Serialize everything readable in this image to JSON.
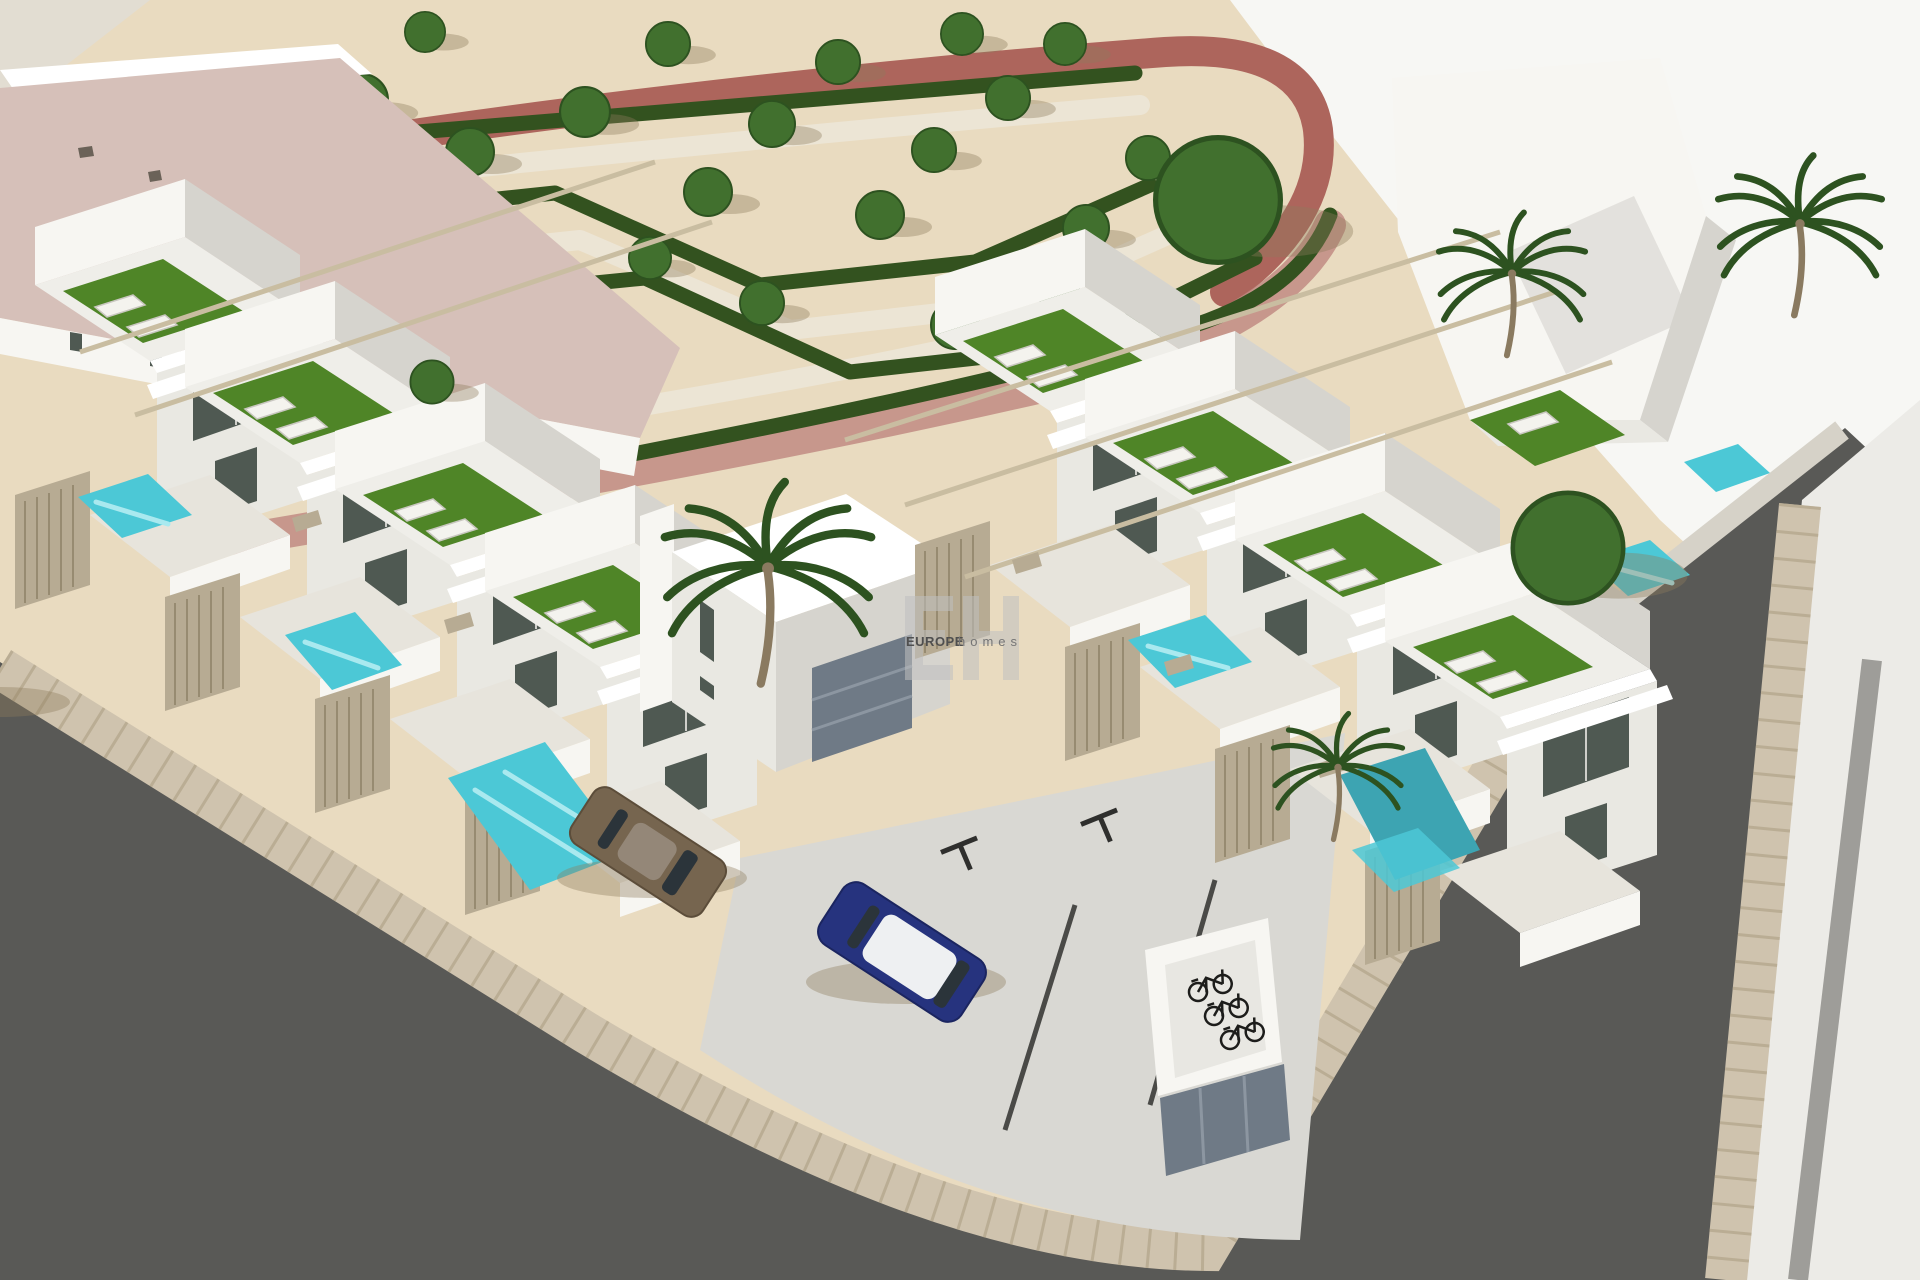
{
  "image": {
    "kind": "3d-architectural-render",
    "view": "aerial-corner-view"
  },
  "watermark": {
    "monogram": "EH",
    "brand": "EUROPE",
    "brand_suffix": "homes"
  },
  "palette": {
    "sand": "#e9dbc0",
    "bright": "#f7f7f4",
    "wedge": "#e2ddd2",
    "parkPath": "#ece5d5",
    "hedge": "#33521f",
    "tree": "#41702e",
    "treeDark": "#2d5220",
    "trunk": "#8a7a60",
    "shadow": "#8d7c5d",
    "redPath": "#ad655c",
    "redPathLight": "#c18b82",
    "pinkRoof": "#d6c0b9",
    "speck": "#6b6258",
    "wallLit": "#f7f6f2",
    "wallMid": "#e9e8e2",
    "wallShade": "#d6d4ce",
    "terrace": "#efeee9",
    "parapet": "#ffffff",
    "glass": "#4f5952",
    "mull": "#cfcfca",
    "turf": "#4f8527",
    "patio": "#e7e4dc",
    "lounger": "#f4f3ee",
    "loungerEdge": "#c9c7c0",
    "fence": "#b7ab93",
    "fenceLine": "#978b71",
    "pool": "#4cc8d6",
    "poolDeep": "#3da4b2",
    "poolLight": "#a9e9ef",
    "pergola": "#c9bda1",
    "road": "#595956",
    "curb": "#cfc3ae",
    "curbJoint": "#b3a58b",
    "lightBand": "#d6d2c8",
    "sidewalk": "#ecebe7",
    "stripe": "#9e9d99",
    "apron": "#d9d8d3",
    "joint": "#4a4a47",
    "markDark": "#2f2f2d",
    "carBronze": "#76654f",
    "carBronzeEdge": "#5c4d3a",
    "carBlue": "#26337e",
    "carBlueEdge": "#1b2560",
    "carGlass": "#2b343a",
    "carRoof": "#eef0f2",
    "bike": "#1d1d1b",
    "shelterFloor": "#e8e7e2",
    "panel": "#6f7a86",
    "panelLine": "#8c96a1",
    "wmGray": "#c0c0c0",
    "wmText": "#4f4f4f",
    "wmText2": "#757575"
  },
  "scene": {
    "labels": [
      "landscaped park with hedge parterre and trees",
      "red walkway around park",
      "pink-roof clubhouse building",
      "left row of white townhouses with rooftop terraces",
      "right row of white townhouses with rooftop terraces",
      "corner tower house",
      "turquoise plunge pools",
      "palm trees",
      "asphalt streets with paver curbs",
      "parking apron with bays",
      "bronze car",
      "blue car with white roof",
      "bicycle shelter with bikes",
      "white sidewalk with gray stripe"
    ]
  }
}
